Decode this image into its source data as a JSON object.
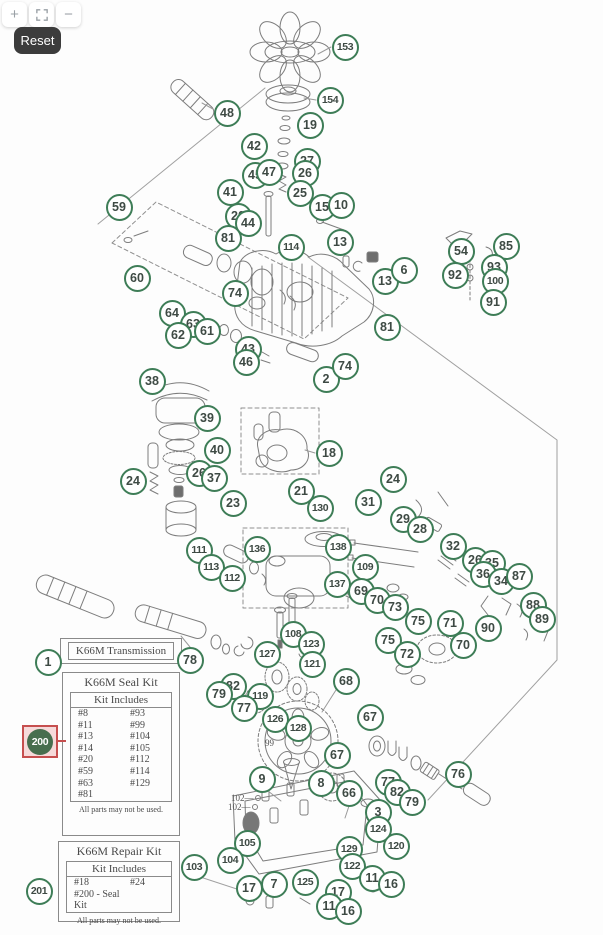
{
  "controls": {
    "zoom_in_glyph": "+",
    "zoom_out_glyph": "−",
    "fullscreen_icon": "fullscreen-icon",
    "reset_label": "Reset"
  },
  "colors": {
    "callout_green": "#3e7d57",
    "callout_text": "#3e4a44",
    "highlight_red": "#c64f4f",
    "highlight_fill": "#f6dada",
    "highlight_circle": "#476e4e",
    "sketch_gray": "#7d7d7d"
  },
  "boxes": {
    "transmission": {
      "title": "K66M Transmission"
    },
    "seal_kit": {
      "title": "K66M Seal Kit",
      "header": "Kit Includes",
      "left": [
        "#8",
        "#11",
        "#13",
        "#14",
        "#20",
        "#59",
        "#63",
        "#81"
      ],
      "right": [
        "#93",
        "#99",
        "#104",
        "#105",
        "#112",
        "#114",
        "#129"
      ],
      "footer": "All parts may not be used."
    },
    "repair_kit": {
      "title": "K66M Repair Kit",
      "header": "Kit Includes",
      "rows": [
        [
          "#18",
          "#24"
        ],
        [
          "#200 - Seal Kit",
          ""
        ]
      ],
      "footer": "All parts may not be used."
    }
  },
  "highlight": {
    "n": "200",
    "x": 40,
    "y": 741
  },
  "diagram": {
    "callouts": [
      [
        "153",
        345,
        47
      ],
      [
        "154",
        330,
        100
      ],
      [
        "48",
        227,
        113
      ],
      [
        "19",
        310,
        125
      ],
      [
        "42",
        254,
        146
      ],
      [
        "27",
        307,
        161
      ],
      [
        "26",
        305,
        173
      ],
      [
        "45",
        255,
        175
      ],
      [
        "47",
        269,
        172
      ],
      [
        "25",
        300,
        193
      ],
      [
        "41",
        230,
        192
      ],
      [
        "15",
        322,
        207
      ],
      [
        "10",
        341,
        205
      ],
      [
        "59",
        119,
        207
      ],
      [
        "20",
        238,
        216
      ],
      [
        "44",
        248,
        223
      ],
      [
        "81",
        228,
        238
      ],
      [
        "114",
        291,
        247
      ],
      [
        "13",
        340,
        242
      ],
      [
        "13",
        385,
        281
      ],
      [
        "6",
        404,
        270
      ],
      [
        "54",
        461,
        251
      ],
      [
        "85",
        506,
        246
      ],
      [
        "92",
        455,
        275
      ],
      [
        "93",
        494,
        267
      ],
      [
        "100",
        495,
        281
      ],
      [
        "91",
        493,
        302
      ],
      [
        "60",
        137,
        278
      ],
      [
        "74",
        235,
        293
      ],
      [
        "64",
        172,
        313
      ],
      [
        "63",
        193,
        324
      ],
      [
        "62",
        178,
        335
      ],
      [
        "61",
        207,
        331
      ],
      [
        "81",
        387,
        327
      ],
      [
        "43",
        248,
        349
      ],
      [
        "46",
        246,
        362
      ],
      [
        "2",
        326,
        379
      ],
      [
        "74",
        345,
        366
      ],
      [
        "38",
        152,
        381
      ],
      [
        "39",
        207,
        418
      ],
      [
        "40",
        217,
        450
      ],
      [
        "24",
        133,
        481
      ],
      [
        "26",
        199,
        473
      ],
      [
        "37",
        214,
        478
      ],
      [
        "23",
        233,
        503
      ],
      [
        "18",
        329,
        453
      ],
      [
        "21",
        301,
        491
      ],
      [
        "130",
        320,
        508
      ],
      [
        "31",
        368,
        502
      ],
      [
        "24",
        393,
        479
      ],
      [
        "29",
        403,
        519
      ],
      [
        "28",
        420,
        529
      ],
      [
        "32",
        453,
        546
      ],
      [
        "26",
        475,
        560
      ],
      [
        "35",
        492,
        563
      ],
      [
        "36",
        483,
        574
      ],
      [
        "34",
        501,
        581
      ],
      [
        "87",
        519,
        576
      ],
      [
        "88",
        533,
        605
      ],
      [
        "89",
        542,
        619
      ],
      [
        "90",
        488,
        628
      ],
      [
        "111",
        199,
        550
      ],
      [
        "113",
        211,
        567
      ],
      [
        "112",
        232,
        578
      ],
      [
        "136",
        257,
        549
      ],
      [
        "138",
        338,
        547
      ],
      [
        "137",
        337,
        584
      ],
      [
        "109",
        365,
        567
      ],
      [
        "69",
        361,
        591
      ],
      [
        "70",
        377,
        600
      ],
      [
        "73",
        395,
        607
      ],
      [
        "75",
        418,
        621
      ],
      [
        "71",
        450,
        623
      ],
      [
        "75",
        388,
        640
      ],
      [
        "72",
        407,
        654
      ],
      [
        "70",
        463,
        645
      ],
      [
        "108",
        293,
        634
      ],
      [
        "123",
        311,
        644
      ],
      [
        "121",
        312,
        664
      ],
      [
        "127",
        267,
        654
      ],
      [
        "82",
        233,
        686
      ],
      [
        "79",
        219,
        694
      ],
      [
        "119",
        260,
        696
      ],
      [
        "77",
        244,
        708
      ],
      [
        "126",
        275,
        719
      ],
      [
        "128",
        298,
        728
      ],
      [
        "68",
        346,
        681
      ],
      [
        "67",
        370,
        717
      ],
      [
        "67",
        337,
        755
      ],
      [
        "9",
        262,
        779
      ],
      [
        "8",
        321,
        783
      ],
      [
        "66",
        349,
        793
      ],
      [
        "76",
        458,
        774
      ],
      [
        "77",
        388,
        782
      ],
      [
        "82",
        397,
        792
      ],
      [
        "79",
        412,
        802
      ],
      [
        "3",
        378,
        812
      ],
      [
        "124",
        378,
        829
      ],
      [
        "120",
        396,
        846
      ],
      [
        "129",
        349,
        849
      ],
      [
        "122",
        352,
        866
      ],
      [
        "11",
        372,
        878
      ],
      [
        "16",
        391,
        884
      ],
      [
        "105",
        247,
        843
      ],
      [
        "104",
        230,
        860
      ],
      [
        "103",
        194,
        867
      ],
      [
        "17",
        249,
        888
      ],
      [
        "7",
        274,
        884
      ],
      [
        "125",
        305,
        882
      ],
      [
        "17",
        338,
        892
      ],
      [
        "11",
        329,
        906
      ],
      [
        "16",
        348,
        911
      ],
      [
        "1",
        48,
        662
      ],
      [
        "78",
        190,
        660
      ],
      [
        "201",
        39,
        891
      ]
    ],
    "text_labels": [
      [
        "99",
        265,
        738
      ],
      [
        "102—",
        231,
        793
      ],
      [
        "102—",
        228,
        802
      ]
    ]
  }
}
